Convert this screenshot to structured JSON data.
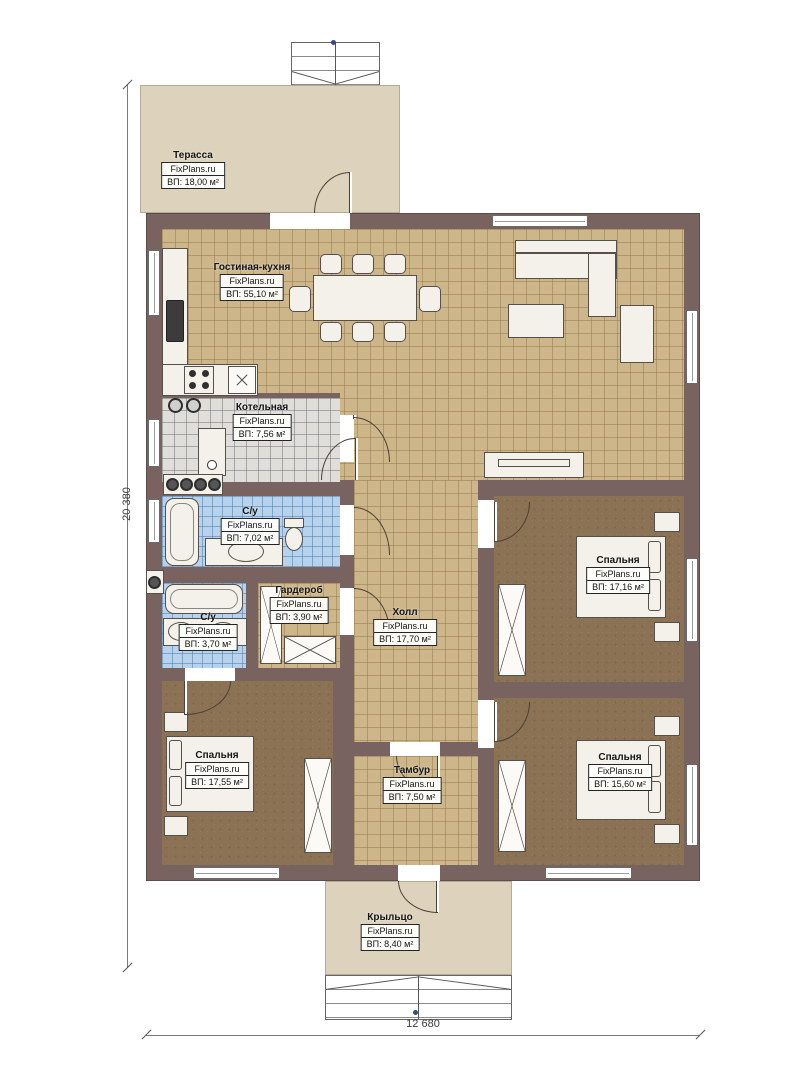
{
  "brand": "FixPlans.ru",
  "rooms": [
    {
      "name": "Терасса",
      "area": "ВП: 18,00 м²"
    },
    {
      "name": "Гостиная-кухня",
      "area": "ВП: 55,10 м²"
    },
    {
      "name": "Котельная",
      "area": "ВП: 7,56 м²"
    },
    {
      "name": "С/у",
      "area": "ВП: 7,02 м²"
    },
    {
      "name": "Гардероб",
      "area": "ВП: 3,90 м²"
    },
    {
      "name": "С/у",
      "area": "ВП: 3,70 м²"
    },
    {
      "name": "Холл",
      "area": "ВП: 17,70 м²"
    },
    {
      "name": "Спальня",
      "area": "ВП: 17,16 м²"
    },
    {
      "name": "Спальня",
      "area": "ВП: 17,55 м²"
    },
    {
      "name": "Тамбур",
      "area": "ВП: 7,50 м²"
    },
    {
      "name": "Спальня",
      "area": "ВП: 15,60 м²"
    },
    {
      "name": "Крыльцо",
      "area": "ВП: 8,40 м²"
    }
  ],
  "dimensions": {
    "height": "20 380",
    "width": "12 680"
  },
  "colors": {
    "wall": "#796361",
    "floor_tile": "#cdb68a",
    "boiler_tile": "#e0dedb",
    "bathroom_tile": "#b7d2ec",
    "bedroom_floor": "#8b7254",
    "terrace": "#ddd3bd",
    "marker_dot": "#39488a"
  }
}
